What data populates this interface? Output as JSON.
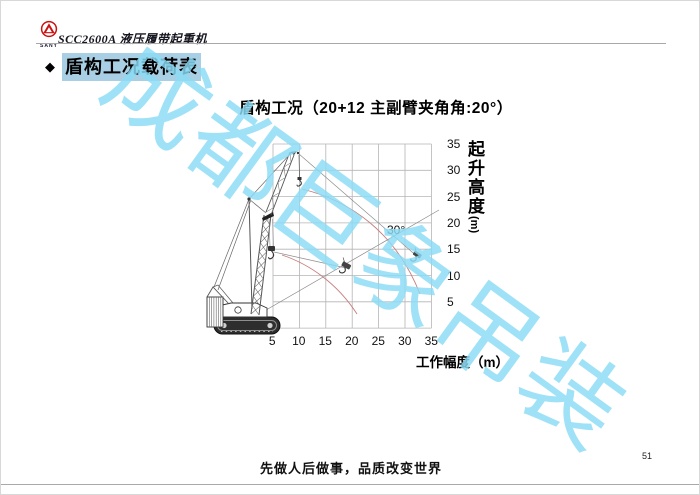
{
  "header": {
    "logo_text": "SANY",
    "doc_title": "SCC2600A 液压履带起重机"
  },
  "section": {
    "bullet": "◆",
    "title": "盾构工况载荷表"
  },
  "chart": {
    "title": "盾构工况（20+12 主副臂夹角角:20°）",
    "annotation_angle": "30°",
    "x_axis": {
      "title": "工作幅度（m）",
      "ticks": [
        "5",
        "10",
        "15",
        "20",
        "25",
        "30",
        "35"
      ]
    },
    "y_axis": {
      "title": "起升高度",
      "unit": "(m)",
      "ticks": [
        "35",
        "30",
        "25",
        "20",
        "15",
        "10",
        "5"
      ]
    },
    "grid": {
      "x_range": [
        5,
        35
      ],
      "y_range": [
        0,
        35
      ],
      "step": 5
    }
  },
  "watermark": {
    "text": "成都巨象吊装"
  },
  "footer": {
    "slogan": "先做人后做事，品质改变世界",
    "page_number": "51"
  },
  "colors": {
    "watermark": "#8bdcf6",
    "highlight": "#a8cfe4",
    "curve_red": "#c97c7c",
    "grid": "#b5b5b5",
    "logo_red": "#cc1111"
  }
}
